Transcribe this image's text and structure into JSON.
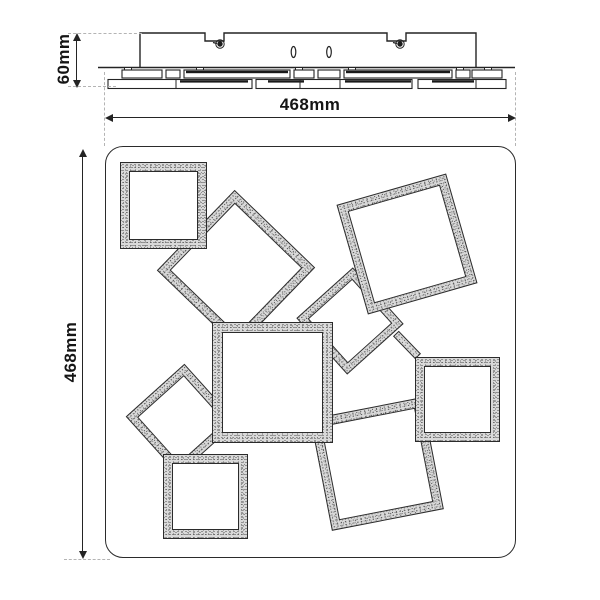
{
  "figure": {
    "type": "technical-dimension-drawing",
    "views": [
      "side-profile",
      "bottom-face"
    ]
  },
  "dimensions": {
    "fixture_height_label": "60mm",
    "fixture_width_label": "468mm",
    "fixture_depth_label": "468mm"
  },
  "colors": {
    "line": "#242424",
    "dash": "#b4b4b4",
    "speckle_base": "#d9d9d9",
    "background": "#ffffff"
  },
  "side_view": {
    "canopy": {
      "x": 140,
      "y": 33,
      "w": 336,
      "h": 34.5
    },
    "notches": [
      {
        "x": 205,
        "w": 19,
        "depth": 8,
        "screw_x": 220,
        "screw_y": 44
      },
      {
        "x": 387,
        "w": 19,
        "depth": 8,
        "screw_x": 400,
        "screw_y": 44
      }
    ],
    "slots": [
      {
        "cx": 293.5,
        "cy": 52,
        "rx": 2.3,
        "ry": 5.5
      },
      {
        "cx": 329,
        "cy": 52,
        "rx": 2.3,
        "ry": 5.5
      }
    ],
    "baseline": {
      "x1": 98,
      "x2": 515,
      "y": 67.5
    },
    "tabs": [
      128,
      200,
      299,
      352,
      460,
      488
    ],
    "row_a": {
      "y": 70,
      "h": 8,
      "boxes": [
        {
          "x": 122,
          "w": 40,
          "dark": false
        },
        {
          "x": 166,
          "w": 14,
          "dark": false
        },
        {
          "x": 184,
          "w": 106,
          "dark": true
        },
        {
          "x": 294,
          "w": 20,
          "dark": false
        },
        {
          "x": 318,
          "w": 22,
          "dark": false
        },
        {
          "x": 344,
          "w": 108,
          "dark": true
        },
        {
          "x": 456,
          "w": 14,
          "dark": false
        },
        {
          "x": 472,
          "w": 30,
          "dark": false
        }
      ]
    },
    "row_b": {
      "y": 79.5,
      "h": 9,
      "boxes": [
        {
          "x": 108,
          "w": 144,
          "strips": [
            [
              180,
              68
            ]
          ],
          "dividers": [
            176
          ]
        },
        {
          "x": 256,
          "w": 156,
          "strips": [
            [
              268,
              36
            ],
            [
              345,
              66
            ]
          ],
          "dividers": [
            300,
            340
          ]
        },
        {
          "x": 418,
          "w": 88,
          "strips": [
            [
              432,
              42
            ]
          ],
          "dividers": [
            476
          ]
        }
      ]
    }
  },
  "panel": {
    "x": 104.5,
    "y": 146,
    "w": 411,
    "h": 411.5,
    "radius": 18
  },
  "squares": [
    {
      "name": "square-upper-diamond",
      "cx": 236,
      "cy": 269,
      "size": 112,
      "rot": 44,
      "bw": 9,
      "z": 1
    },
    {
      "name": "square-mid-diamond",
      "cx": 350,
      "cy": 321,
      "size": 76,
      "rot": 48,
      "bw": 8,
      "z": 2
    },
    {
      "name": "square-left-diamond",
      "cx": 181,
      "cy": 419,
      "size": 79,
      "rot": 48,
      "bw": 8,
      "z": 3
    },
    {
      "name": "square-bottom-right",
      "cx": 377,
      "cy": 464,
      "size": 114,
      "rot": -11,
      "bw": 9,
      "z": 4
    },
    {
      "name": "square-top-left",
      "cx": 163.5,
      "cy": 205,
      "size": 87,
      "rot": 0,
      "bw": 9,
      "z": 5
    },
    {
      "name": "square-top-right",
      "cx": 406.5,
      "cy": 244,
      "size": 114,
      "rot": -16,
      "bw": 9,
      "z": 6
    },
    {
      "name": "square-bottom-left",
      "cx": 205,
      "cy": 496.5,
      "size": 85,
      "rot": 0,
      "bw": 9,
      "z": 7
    },
    {
      "name": "square-right",
      "cx": 457.5,
      "cy": 399.5,
      "size": 85,
      "rot": 0,
      "bw": 9,
      "z": 8
    },
    {
      "name": "square-center",
      "cx": 272.5,
      "cy": 382.5,
      "size": 121,
      "rot": 0,
      "bw": 10,
      "z": 9
    }
  ],
  "connectors": [
    {
      "name": "weld-bar",
      "cx": 407,
      "cy": 345,
      "len": 32,
      "w": 8,
      "rot": 46,
      "z": 3
    }
  ],
  "dim_geometry": {
    "height_dim": {
      "arrow_x": 77,
      "y1": 33,
      "y2": 86.5
    },
    "width_dim": {
      "arrow_y": 117.5,
      "x1": 104.5,
      "x2": 515.5
    },
    "depth_dim": {
      "arrow_x": 82.5,
      "y1": 149,
      "y2": 557.5
    }
  }
}
